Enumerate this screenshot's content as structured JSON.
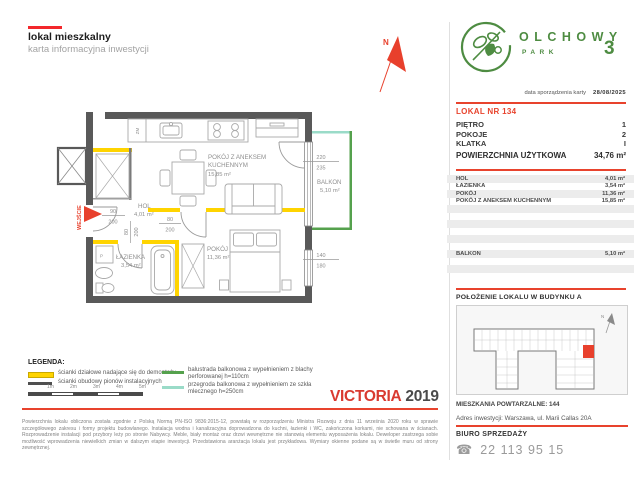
{
  "header": {
    "doc_type": "lokal mieszkalny",
    "doc_subtitle": "karta informacyjna inwestycji"
  },
  "brand": {
    "name": "OLCHOWY",
    "park": "PARK",
    "number": "3",
    "green": "#4e8c42"
  },
  "card": {
    "date_label": "data sporządzenia karty",
    "date_value": "28/08/2025",
    "unit_label": "LOKAL NR 134",
    "attributes": [
      {
        "label": "PIĘTRO",
        "value": "1"
      },
      {
        "label": "POKOJE",
        "value": "2"
      },
      {
        "label": "KLATKA",
        "value": "I"
      }
    ],
    "area_label": "POWIERZCHNIA UŻYTKOWA",
    "area_value": "34,76 m²",
    "rooms": [
      {
        "name": "HOL",
        "area": "4,01 m²"
      },
      {
        "name": "ŁAZIENKA",
        "area": "3,54 m²"
      },
      {
        "name": "POKÓJ",
        "area": "11,36 m²"
      },
      {
        "name": "POKÓJ Z ANEKSEM KUCHENNYM",
        "area": "15,85 m²"
      }
    ],
    "balcony": {
      "name": "BALKON",
      "area": "5,10 m²"
    },
    "location_title": "POŁOŻENIE LOKALU W BUDYNKU A",
    "locator_north": "N",
    "repeatable": "MIESZKANIA POWTARZALNE: 144",
    "address": "Adres inwestycji: Warszawa, ul. Marii Callas 20A",
    "sales_office_label": "BIURO SPRZEDAŻY",
    "phone": "22 113 95 15"
  },
  "plan": {
    "living": {
      "line1": "POKÓJ Z ANEKSEM",
      "line2": "KUCHENNYM",
      "area": "15,85 m²"
    },
    "hol": {
      "name": "HOL",
      "area": "4,01 m²"
    },
    "bath": {
      "name": "ŁAZIENKA",
      "area": "3,54 m²"
    },
    "bedroom": {
      "name": "POKÓJ",
      "area": "11,36 m²"
    },
    "balcony": {
      "name": "BALKON",
      "area": "5,10 m²"
    },
    "entrance_label": "WEJŚCIE",
    "north_label": "N",
    "kitchen_dishwasher_label": "ZM",
    "washer_label": "P",
    "dims": {
      "entrance": {
        "w": "90",
        "h": "200"
      },
      "bath_door": {
        "w": "80",
        "h": "200"
      },
      "bedroom_door": {
        "w": "80",
        "h": "200"
      },
      "balcony_window": {
        "w": "220",
        "h": "235"
      },
      "bedroom_window": {
        "w": "140",
        "h": "180"
      }
    },
    "colors": {
      "wall": "#595959",
      "partition_yellow": "#ffd400",
      "balustrade_green": "#55a14d",
      "partition_cyan": "#9adbc8",
      "accent_red": "#e8402c"
    }
  },
  "legend": {
    "title": "LEGENDA:",
    "items": [
      {
        "text": "ścianki działowe nadające się do demontażu",
        "swatch": "#ffd400"
      },
      {
        "text": "ścianki obudowy pionów instalacyjnych",
        "swatch": "#4f4f4f"
      },
      {
        "text": "balustrada balkonowa z wypełnieniem z blachy perforowanej h=110cm",
        "swatch": "#55a14d"
      },
      {
        "text": "przegroda balkonowa z wypełnieniem ze szkła mlecznego h=250cm",
        "swatch": "#9adbc8"
      }
    ],
    "scale": [
      "1m",
      "2m",
      "3m",
      "4m",
      "5m"
    ]
  },
  "developer": {
    "name": "VICTORIA",
    "year": "2019"
  },
  "disclaimer": "Powierzchnia lokalu obliczona została zgodnie z Polską Normą PN-ISO 9836:2015-12, powstałą w rozporządzeniu Ministra Rozwoju z dnia 11 września 2020 roku w sprawie szczegółowego zakresu i formy projektu budowlanego. Instalacja wodna i kanalizacyjna doprowadzona do kuchni, łazienki i WC, zakończona korkami, nie schowana w ścianach. Rozprowadzenie instalacji pod przybory leży po stronie Nabywcy. Meble, biały montaż oraz drzwi wewnętrzne nie stanowią elementu wyposażenia lokalu. Deweloper zastrzega sobie możliwość wprowadzenia niewielkich zmian w dalszym etapie inwestycji. Przedstawiona aranżacja lokalu jest przykładowa. Wymiary okienne podane są w świetle muru od strony zewnętrznej."
}
